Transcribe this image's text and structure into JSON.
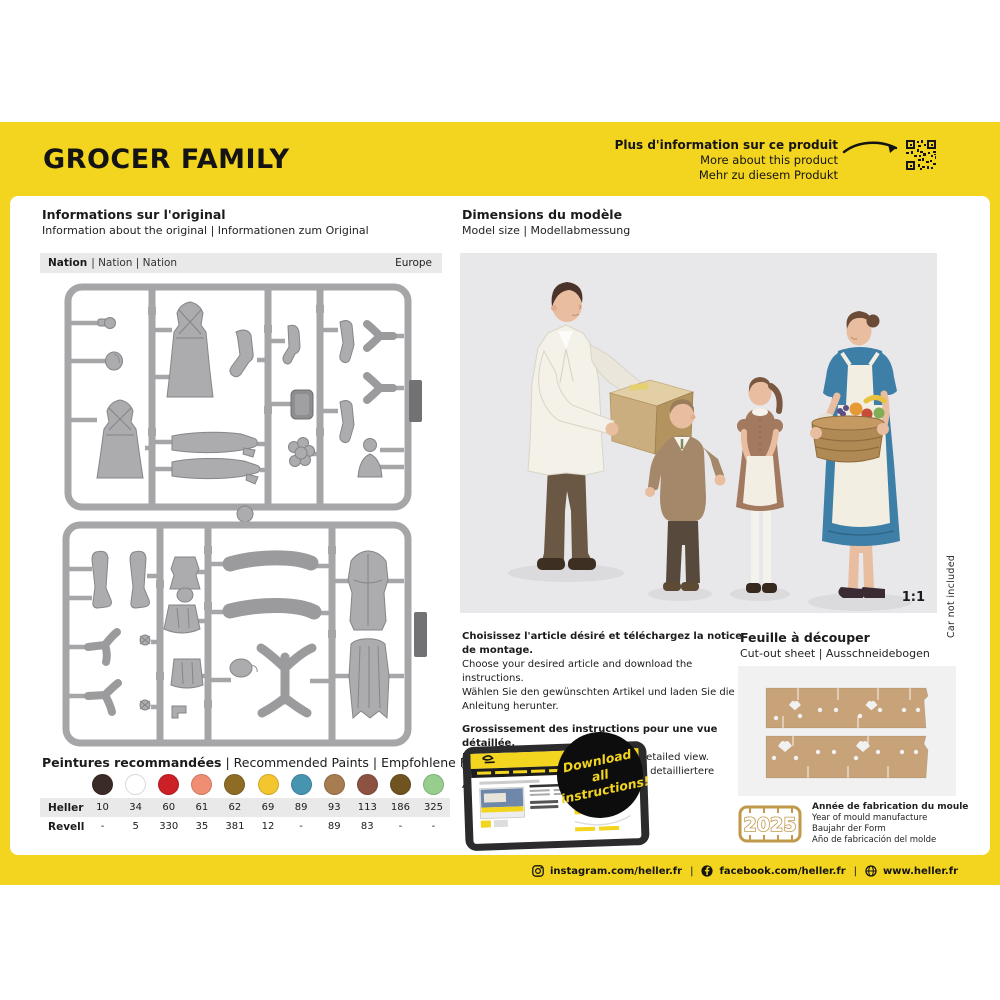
{
  "sep": "|",
  "page": {
    "title": "GROCER FAMILY",
    "footer": {
      "instagram": "instagram.com/heller.fr",
      "facebook": "facebook.com/heller.fr",
      "website": "www.heller.fr"
    }
  },
  "more_info": {
    "fr": "Plus d'information sur ce produit",
    "en": "More about this product",
    "de": "Mehr zu diesem Produkt"
  },
  "original_info": {
    "title_fr": "Informations sur l'original",
    "subtitle": "Information about the original | Informationen zum Original",
    "nation_label": "Nation",
    "nation_rest": "| Nation | Nation",
    "nation_value": "Europe"
  },
  "dimensions": {
    "title_fr": "Dimensions du modèle",
    "subtitle": "Model size | Modellabmessung",
    "scale": "1:1",
    "car_note": "Car not included"
  },
  "download": {
    "p1_fr": "Choisissez l'article désiré et téléchargez la notice de montage.",
    "p1_en": "Choose your desired article and download the instructions.",
    "p1_de": "Wählen Sie den gewünschten Artikel und laden Sie die Anleitung herunter.",
    "p2_fr": "Grossissement des instructions pour une vue détaillée.",
    "p2_en": "Enlarge the instructions for a more detailed view.",
    "p2_de": "Vergrößern Sie die Anleitung für eine detailliertere Ansicht.",
    "badge_line1": "Download all",
    "badge_line2": "instructions!"
  },
  "cutout": {
    "title_fr": "Feuille à découper",
    "subtitle": "Cut-out sheet | Ausschneidebogen"
  },
  "mould": {
    "year": "2025",
    "fr": "Année de fabrication du moule",
    "en": "Year of mould manufacture",
    "de": "Baujahr der Form",
    "es": "Año de fabricación del molde"
  },
  "paints": {
    "title_fr": "Peintures recommandées",
    "title_rest": "| Recommended Paints | Empfohlene Farben",
    "row_labels": [
      "Heller",
      "Revell"
    ],
    "items": [
      {
        "color": "#3B2B26",
        "heller": "10",
        "revell": "-"
      },
      {
        "color": "#FFFFFF",
        "heller": "34",
        "revell": "5"
      },
      {
        "color": "#CB2026",
        "heller": "60",
        "revell": "330"
      },
      {
        "color": "#EF8E72",
        "heller": "61",
        "revell": "35"
      },
      {
        "color": "#8E6C26",
        "heller": "62",
        "revell": "381"
      },
      {
        "color": "#F3C52F",
        "heller": "69",
        "revell": "12"
      },
      {
        "color": "#4794B1",
        "heller": "89",
        "revell": "-"
      },
      {
        "color": "#A67C50",
        "heller": "93",
        "revell": "89"
      },
      {
        "color": "#8E5243",
        "heller": "113",
        "revell": "83"
      },
      {
        "color": "#6F5420",
        "heller": "186",
        "revell": "-"
      },
      {
        "color": "#97CE8E",
        "heller": "325",
        "revell": "-"
      }
    ]
  },
  "colors": {
    "brand_yellow": "#F3D41F",
    "panel_gray": "#E8E8EA",
    "sprue_gray": "#A6A6A8",
    "cardboard_tan": "#C8A37A",
    "mould_gold": "#C09A4A"
  }
}
